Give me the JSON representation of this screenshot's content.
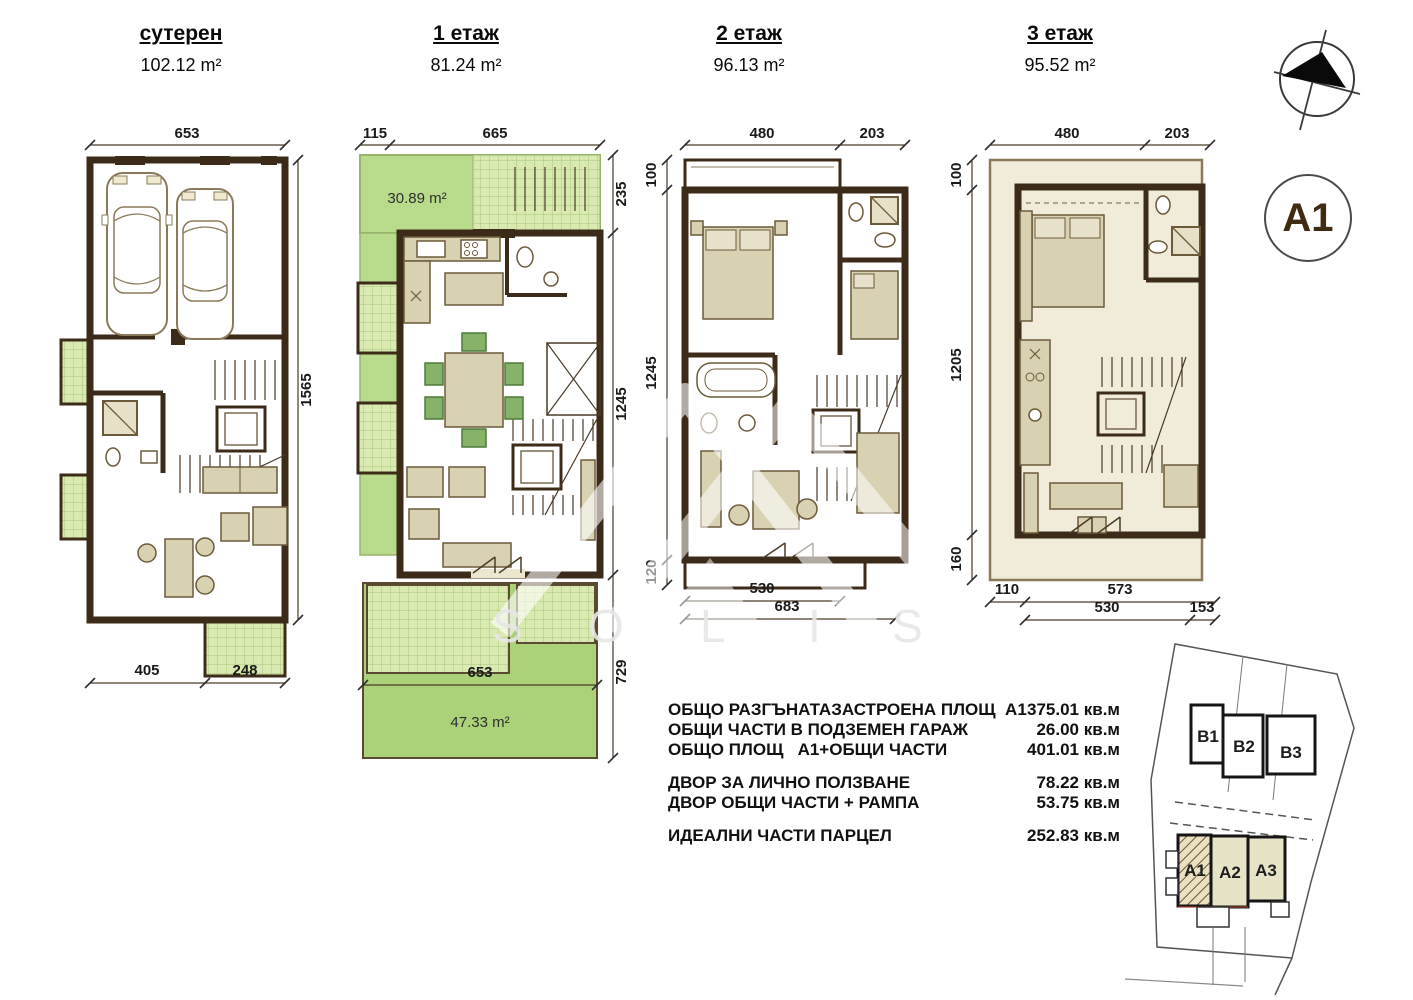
{
  "colors": {
    "wall": "#3c2b18",
    "floor": "#ebe7cf",
    "green_solid": "#b7da8b",
    "green_grid": "#d9e9b0",
    "garden": "#abd279",
    "site_block_fill": "#e7e3c6"
  },
  "floors": [
    {
      "title": "сутерен",
      "area": "102.12 m²",
      "dims": {
        "top": [
          "653"
        ],
        "right": [
          "1565"
        ],
        "bottom": [
          "405",
          "248"
        ]
      }
    },
    {
      "title": "1 етаж",
      "area": "81.24 m²",
      "terrace_area": "30.89 m²",
      "garden_area": "47.33 m²",
      "dims": {
        "top": [
          "115",
          "665"
        ],
        "right": [
          "235",
          "1245",
          "729"
        ],
        "garden": "653"
      }
    },
    {
      "title": "2 етаж",
      "area": "96.13 m²",
      "dims": {
        "top": [
          "480",
          "203"
        ],
        "left": [
          "100",
          "1245",
          "120"
        ],
        "bottom": [
          "530",
          "683"
        ]
      }
    },
    {
      "title": "3 етаж",
      "area": "95.52 m²",
      "dims": {
        "top": [
          "480",
          "203"
        ],
        "left": [
          "100",
          "1205",
          "160"
        ],
        "bottom": [
          "110",
          "573",
          "530",
          "153"
        ]
      }
    }
  ],
  "unit_badge": {
    "label": "A1"
  },
  "summary": {
    "rows": [
      {
        "label": "ОБЩО РАЗГЪНАТАЗАСТРОЕНА ПЛОЩ  А1",
        "value": "375.01 кв.м"
      },
      {
        "label": "ОБЩИ ЧАСТИ В ПОДЗЕМЕН ГАРАЖ",
        "value": "26.00 кв.м"
      },
      {
        "label": "ОБЩО ПЛОЩ   А1+ОБЩИ ЧАСТИ",
        "value": "401.01 кв.м"
      },
      {
        "label": "ДВОР ЗА ЛИЧНО ПОЛЗВАНЕ",
        "value": "78.22 кв.м"
      },
      {
        "label": "ДВОР ОБЩИ ЧАСТИ + РАМПА",
        "value": "53.75 кв.м"
      },
      {
        "label": "ИДЕАЛНИ ЧАСТИ ПАРЦЕЛ",
        "value": "252.83 кв.м"
      }
    ]
  },
  "site_plan": {
    "b_units": [
      "B1",
      "B2",
      "B3"
    ],
    "a_units": [
      "A1",
      "A2",
      "A3"
    ]
  },
  "watermark": {
    "letters": [
      "S",
      "O",
      "L",
      "I",
      "S"
    ]
  }
}
